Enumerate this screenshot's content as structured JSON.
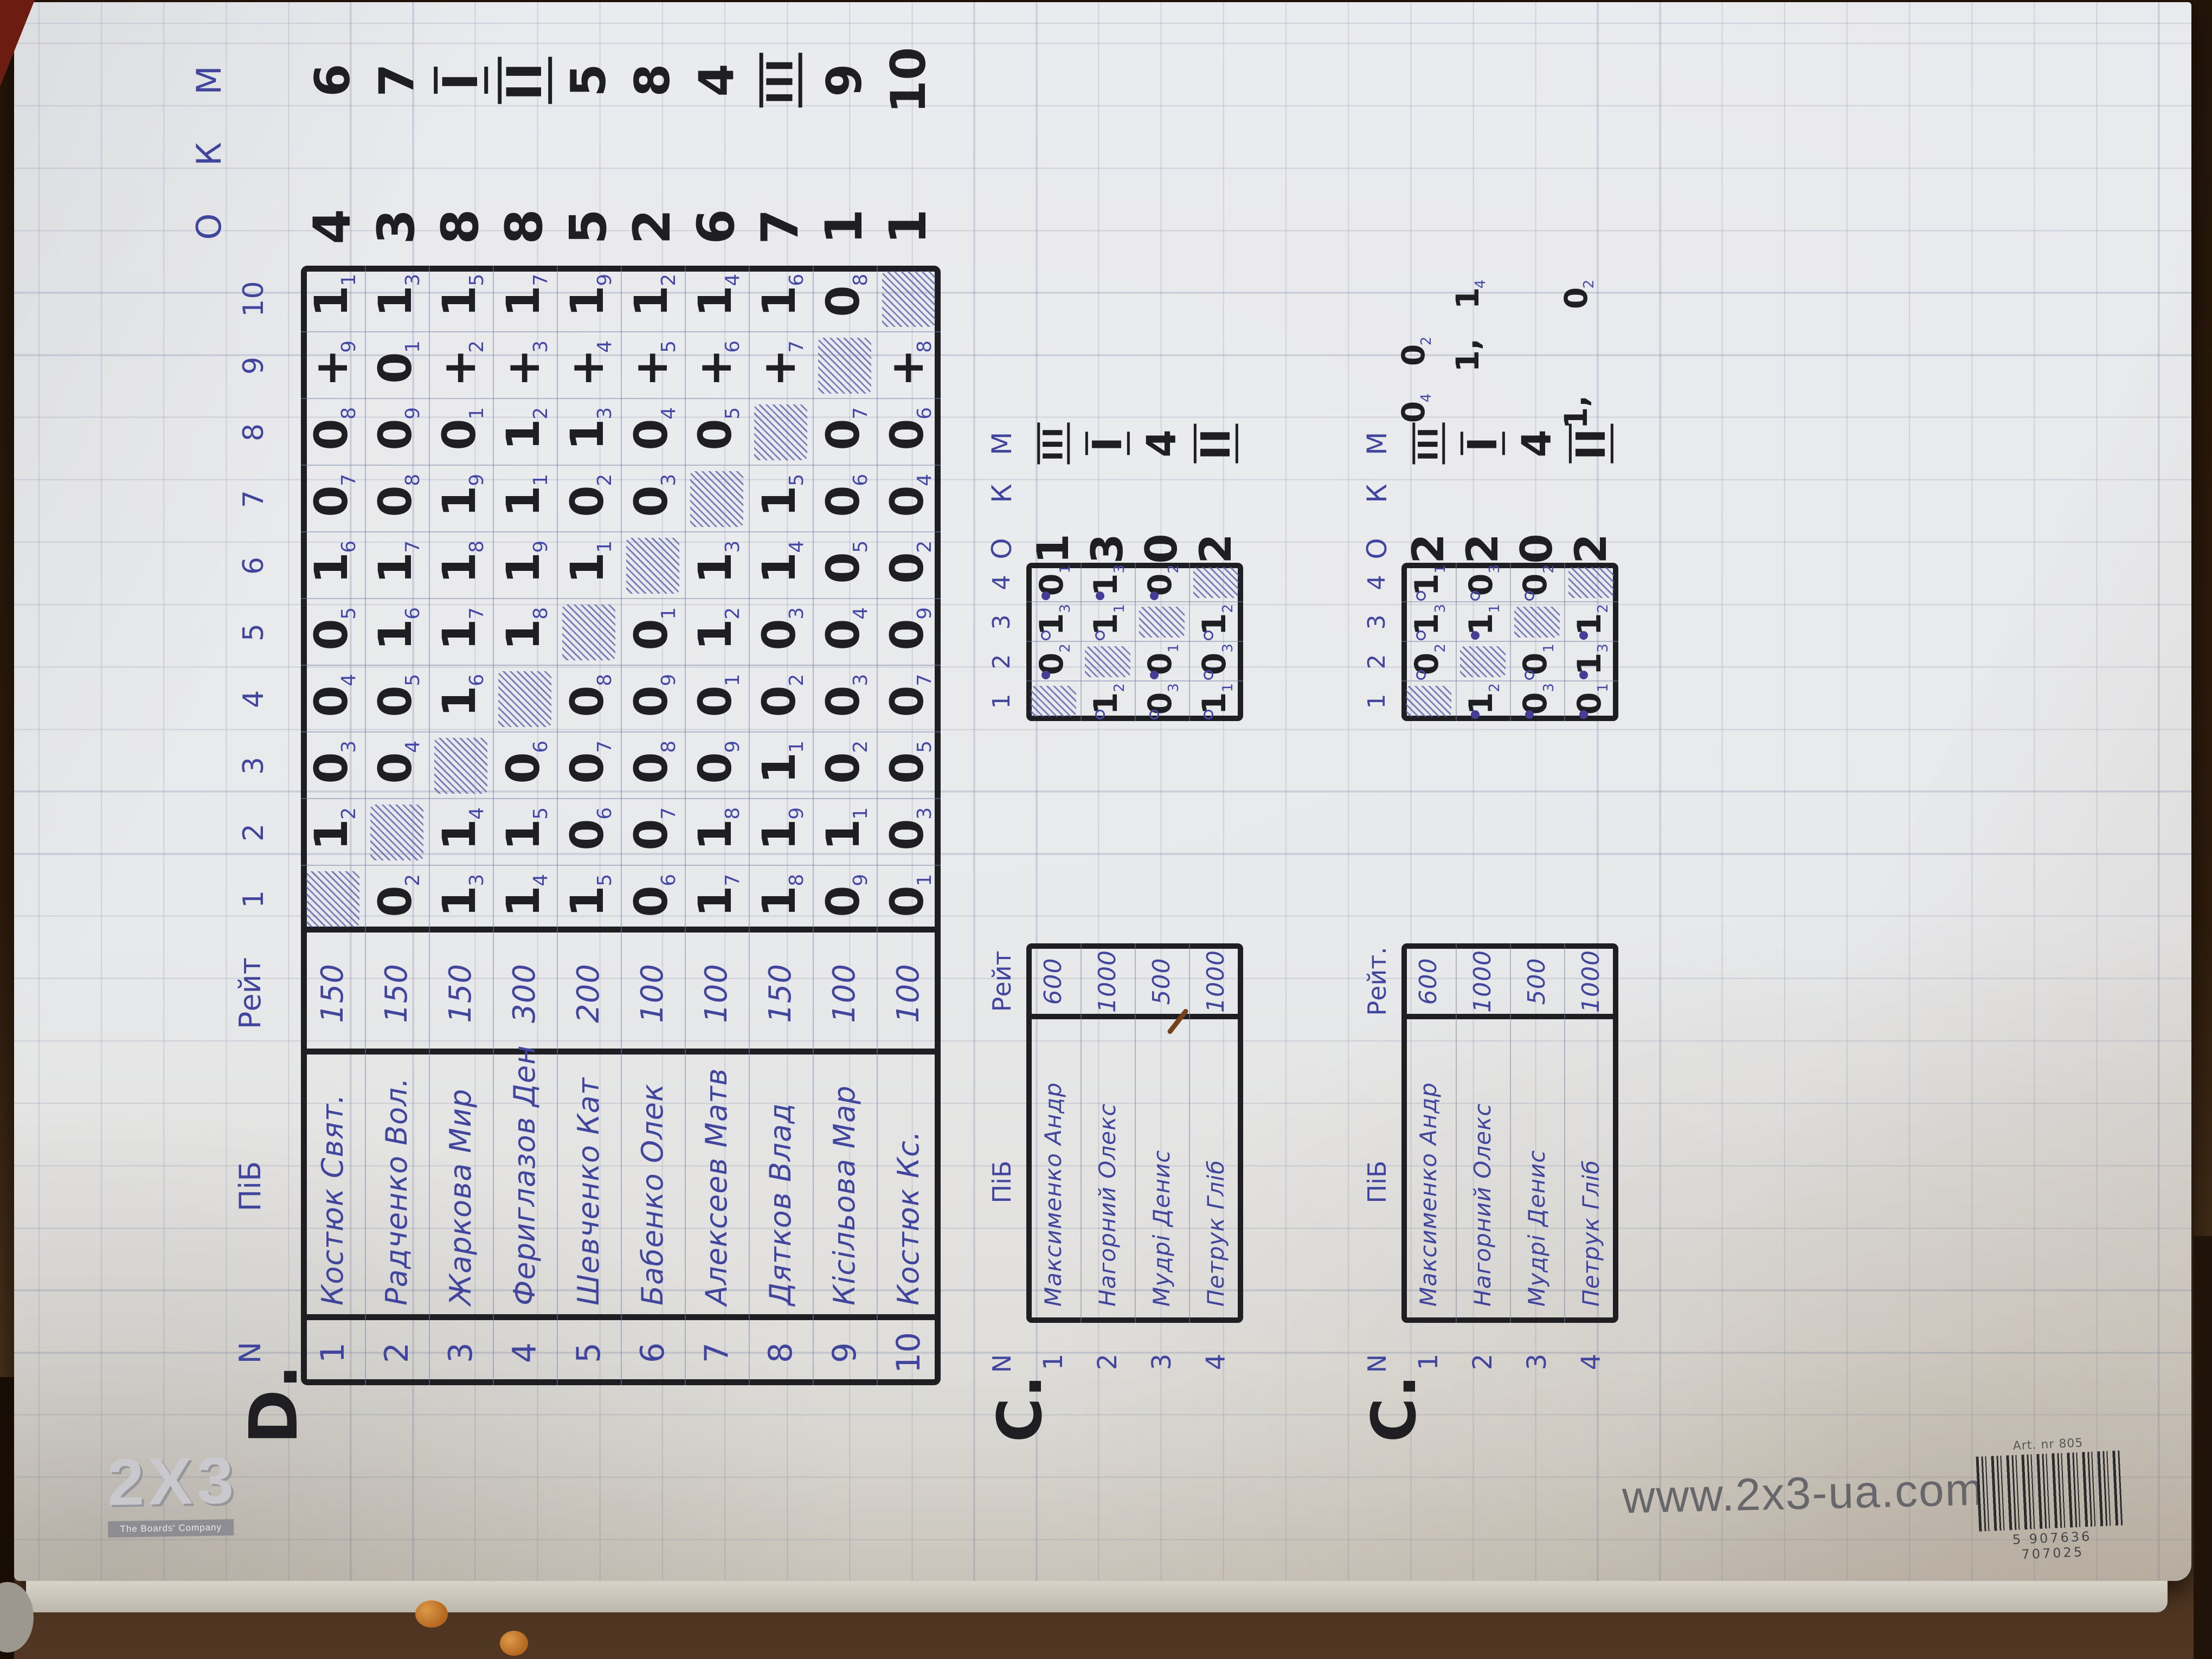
{
  "branding": {
    "logo_main": "2X3",
    "logo_sub": "The Boards' Company",
    "url": "www.2x3-ua.com",
    "barcode_label": "Art. nr 805",
    "barcode_digits": "5 907636 707025"
  },
  "tables": {
    "d": {
      "label": "D.",
      "headers": {
        "n": "N",
        "name": "ПіБ",
        "rating": "Рейт",
        "rounds": [
          "1",
          "2",
          "3",
          "4",
          "5",
          "6",
          "7",
          "8",
          "9",
          "10"
        ],
        "score": "О",
        "koef": "К",
        "place": "М"
      },
      "players": [
        {
          "n": "1",
          "name": "Костюк Свят.",
          "rating": "150",
          "score": "4",
          "place": "6",
          "games": [
            null,
            {
              "v": "1",
              "r": "2"
            },
            {
              "v": "0",
              "r": "3"
            },
            {
              "v": "0",
              "r": "4"
            },
            {
              "v": "0",
              "r": "5"
            },
            {
              "v": "1",
              "r": "6"
            },
            {
              "v": "0",
              "r": "7"
            },
            {
              "v": "0",
              "r": "8"
            },
            {
              "v": "+",
              "r": "9"
            },
            {
              "v": "1",
              "r": "1"
            }
          ]
        },
        {
          "n": "2",
          "name": "Радченко Вол.",
          "rating": "150",
          "score": "3",
          "place": "7",
          "games": [
            {
              "v": "0",
              "r": "2"
            },
            null,
            {
              "v": "0",
              "r": "4"
            },
            {
              "v": "0",
              "r": "5"
            },
            {
              "v": "1",
              "r": "6"
            },
            {
              "v": "1",
              "r": "7"
            },
            {
              "v": "0",
              "r": "8"
            },
            {
              "v": "0",
              "r": "9"
            },
            {
              "v": "0",
              "r": "1"
            },
            {
              "v": "1",
              "r": "3"
            }
          ]
        },
        {
          "n": "3",
          "name": "Жаркова Мир",
          "rating": "150",
          "score": "8",
          "place": "I",
          "games": [
            {
              "v": "1",
              "r": "3"
            },
            {
              "v": "1",
              "r": "4"
            },
            null,
            {
              "v": "1",
              "r": "6"
            },
            {
              "v": "1",
              "r": "7"
            },
            {
              "v": "1",
              "r": "8"
            },
            {
              "v": "1",
              "r": "9"
            },
            {
              "v": "0",
              "r": "1"
            },
            {
              "v": "+",
              "r": "2"
            },
            {
              "v": "1",
              "r": "5"
            }
          ]
        },
        {
          "n": "4",
          "name": "Фериглазов Ден",
          "rating": "300",
          "score": "8",
          "place": "II",
          "games": [
            {
              "v": "1",
              "r": "4"
            },
            {
              "v": "1",
              "r": "5"
            },
            {
              "v": "0",
              "r": "6"
            },
            null,
            {
              "v": "1",
              "r": "8"
            },
            {
              "v": "1",
              "r": "9"
            },
            {
              "v": "1",
              "r": "1"
            },
            {
              "v": "1",
              "r": "2"
            },
            {
              "v": "+",
              "r": "3"
            },
            {
              "v": "1",
              "r": "7"
            }
          ]
        },
        {
          "n": "5",
          "name": "Шевченко Кат",
          "rating": "200",
          "score": "5",
          "place": "5",
          "games": [
            {
              "v": "1",
              "r": "5"
            },
            {
              "v": "0",
              "r": "6"
            },
            {
              "v": "0",
              "r": "7"
            },
            {
              "v": "0",
              "r": "8"
            },
            null,
            {
              "v": "1",
              "r": "1"
            },
            {
              "v": "0",
              "r": "2"
            },
            {
              "v": "1",
              "r": "3"
            },
            {
              "v": "+",
              "r": "4"
            },
            {
              "v": "1",
              "r": "9"
            }
          ]
        },
        {
          "n": "6",
          "name": "Бабенко Олек",
          "rating": "100",
          "score": "2",
          "place": "8",
          "games": [
            {
              "v": "0",
              "r": "6"
            },
            {
              "v": "0",
              "r": "7"
            },
            {
              "v": "0",
              "r": "8"
            },
            {
              "v": "0",
              "r": "9"
            },
            {
              "v": "0",
              "r": "1"
            },
            null,
            {
              "v": "0",
              "r": "3"
            },
            {
              "v": "0",
              "r": "4"
            },
            {
              "v": "+",
              "r": "5"
            },
            {
              "v": "1",
              "r": "2"
            }
          ]
        },
        {
          "n": "7",
          "name": "Алексеев Матв",
          "rating": "100",
          "score": "6",
          "place": "4",
          "games": [
            {
              "v": "1",
              "r": "7"
            },
            {
              "v": "1",
              "r": "8"
            },
            {
              "v": "0",
              "r": "9"
            },
            {
              "v": "0",
              "r": "1"
            },
            {
              "v": "1",
              "r": "2"
            },
            {
              "v": "1",
              "r": "3"
            },
            null,
            {
              "v": "0",
              "r": "5"
            },
            {
              "v": "+",
              "r": "6"
            },
            {
              "v": "1",
              "r": "4"
            }
          ]
        },
        {
          "n": "8",
          "name": "Дятков Влад",
          "rating": "150",
          "score": "7",
          "place": "III",
          "games": [
            {
              "v": "1",
              "r": "8"
            },
            {
              "v": "1",
              "r": "9"
            },
            {
              "v": "1",
              "r": "1"
            },
            {
              "v": "0",
              "r": "2"
            },
            {
              "v": "0",
              "r": "3"
            },
            {
              "v": "1",
              "r": "4"
            },
            {
              "v": "1",
              "r": "5"
            },
            null,
            {
              "v": "+",
              "r": "7"
            },
            {
              "v": "1",
              "r": "6"
            }
          ]
        },
        {
          "n": "9",
          "name": "Кісільова Мар",
          "rating": "100",
          "score": "1",
          "place": "9",
          "games": [
            {
              "v": "0",
              "r": "9"
            },
            {
              "v": "1",
              "r": "1"
            },
            {
              "v": "0",
              "r": "2"
            },
            {
              "v": "0",
              "r": "3"
            },
            {
              "v": "0",
              "r": "4"
            },
            {
              "v": "0",
              "r": "5"
            },
            {
              "v": "0",
              "r": "6"
            },
            {
              "v": "0",
              "r": "7"
            },
            null,
            {
              "v": "0",
              "r": "8"
            }
          ]
        },
        {
          "n": "10",
          "name": "Костюк Кс.",
          "rating": "100",
          "score": "1",
          "place": "10",
          "games": [
            {
              "v": "0",
              "r": "1"
            },
            {
              "v": "0",
              "r": "3"
            },
            {
              "v": "0",
              "r": "5"
            },
            {
              "v": "0",
              "r": "7"
            },
            {
              "v": "0",
              "r": "9"
            },
            {
              "v": "0",
              "r": "2"
            },
            {
              "v": "0",
              "r": "4"
            },
            {
              "v": "0",
              "r": "6"
            },
            {
              "v": "+",
              "r": "8"
            },
            null
          ]
        }
      ]
    },
    "c1": {
      "label": "С.",
      "headers": {
        "n": "N",
        "name": "ПіБ",
        "rating": "Рейт",
        "rounds": [
          "1",
          "2",
          "3",
          "4"
        ],
        "score": "О",
        "koef": "К",
        "place": "М"
      },
      "players": [
        {
          "n": "1",
          "name": "Максименко Андр",
          "rating": "600",
          "score": "1",
          "place": "III",
          "games": [
            null,
            {
              "v": "0",
              "r": "2",
              "d": "f"
            },
            {
              "v": "1",
              "r": "3",
              "d": "o"
            },
            {
              "v": "0",
              "r": "1",
              "d": "f"
            }
          ]
        },
        {
          "n": "2",
          "name": "Нагорний Олекс",
          "rating": "1000",
          "score": "3",
          "place": "I",
          "games": [
            {
              "v": "1",
              "r": "2",
              "d": "o"
            },
            null,
            {
              "v": "1",
              "r": "1",
              "d": "o"
            },
            {
              "v": "1",
              "r": "3",
              "d": "f"
            }
          ]
        },
        {
          "n": "3",
          "name": "Мудрі Денис",
          "rating": "500",
          "score": "0",
          "place": "4",
          "games": [
            {
              "v": "0",
              "r": "3",
              "d": "o"
            },
            {
              "v": "0",
              "r": "1",
              "d": "f"
            },
            null,
            {
              "v": "0",
              "r": "2",
              "d": "f"
            }
          ]
        },
        {
          "n": "4",
          "name": "Петрук Гліб",
          "rating": "1000",
          "score": "2",
          "place": "II",
          "games": [
            {
              "v": "1",
              "r": "1",
              "d": "o"
            },
            {
              "v": "0",
              "r": "3",
              "d": "o"
            },
            {
              "v": "1",
              "r": "2",
              "d": "o"
            },
            null
          ]
        }
      ]
    },
    "c2": {
      "label": "С.",
      "headers": {
        "n": "N",
        "name": "ПіБ",
        "rating": "Рейт.",
        "rounds": [
          "1",
          "2",
          "3",
          "4"
        ],
        "score": "О",
        "koef": "К",
        "place": "М"
      },
      "players": [
        {
          "n": "1",
          "name": "Максименко Андр",
          "rating": "600",
          "score": "2",
          "place": "III",
          "games": [
            null,
            {
              "v": "0",
              "r": "2",
              "d": "o"
            },
            {
              "v": "1",
              "r": "3",
              "d": "o"
            },
            {
              "v": "1",
              "r": "1",
              "d": "o"
            }
          ],
          "extras": [
            {
              "slot": 0,
              "v": "0",
              "r": "4"
            },
            {
              "slot": 1,
              "v": "0",
              "r": "2"
            }
          ]
        },
        {
          "n": "2",
          "name": "Нагорний Олекс",
          "rating": "1000",
          "score": "2",
          "place": "I",
          "games": [
            {
              "v": "1",
              "r": "2",
              "d": "f"
            },
            null,
            {
              "v": "1",
              "r": "1",
              "d": "f"
            },
            {
              "v": "0",
              "r": "3",
              "d": "o"
            }
          ],
          "extras": [
            {
              "slot": 1,
              "v": "1,",
              "r": ""
            },
            {
              "slot": 2,
              "v": "1",
              "r": "4"
            }
          ]
        },
        {
          "n": "3",
          "name": "Мудрі Денис",
          "rating": "500",
          "score": "0",
          "place": "4",
          "games": [
            {
              "v": "0",
              "r": "3",
              "d": "f"
            },
            {
              "v": "0",
              "r": "1",
              "d": "o"
            },
            null,
            {
              "v": "0",
              "r": "2",
              "d": "o"
            }
          ],
          "extras": []
        },
        {
          "n": "4",
          "name": "Петрук Гліб",
          "rating": "1000",
          "score": "2",
          "place": "II",
          "games": [
            {
              "v": "0",
              "r": "1",
              "d": "f"
            },
            {
              "v": "1",
              "r": "3",
              "d": "f"
            },
            {
              "v": "1",
              "r": "2",
              "d": "f"
            },
            null
          ],
          "extras": [
            {
              "slot": 0,
              "v": "1,",
              "r": ""
            },
            {
              "slot": 2,
              "v": "0",
              "r": "2"
            }
          ]
        }
      ]
    }
  }
}
